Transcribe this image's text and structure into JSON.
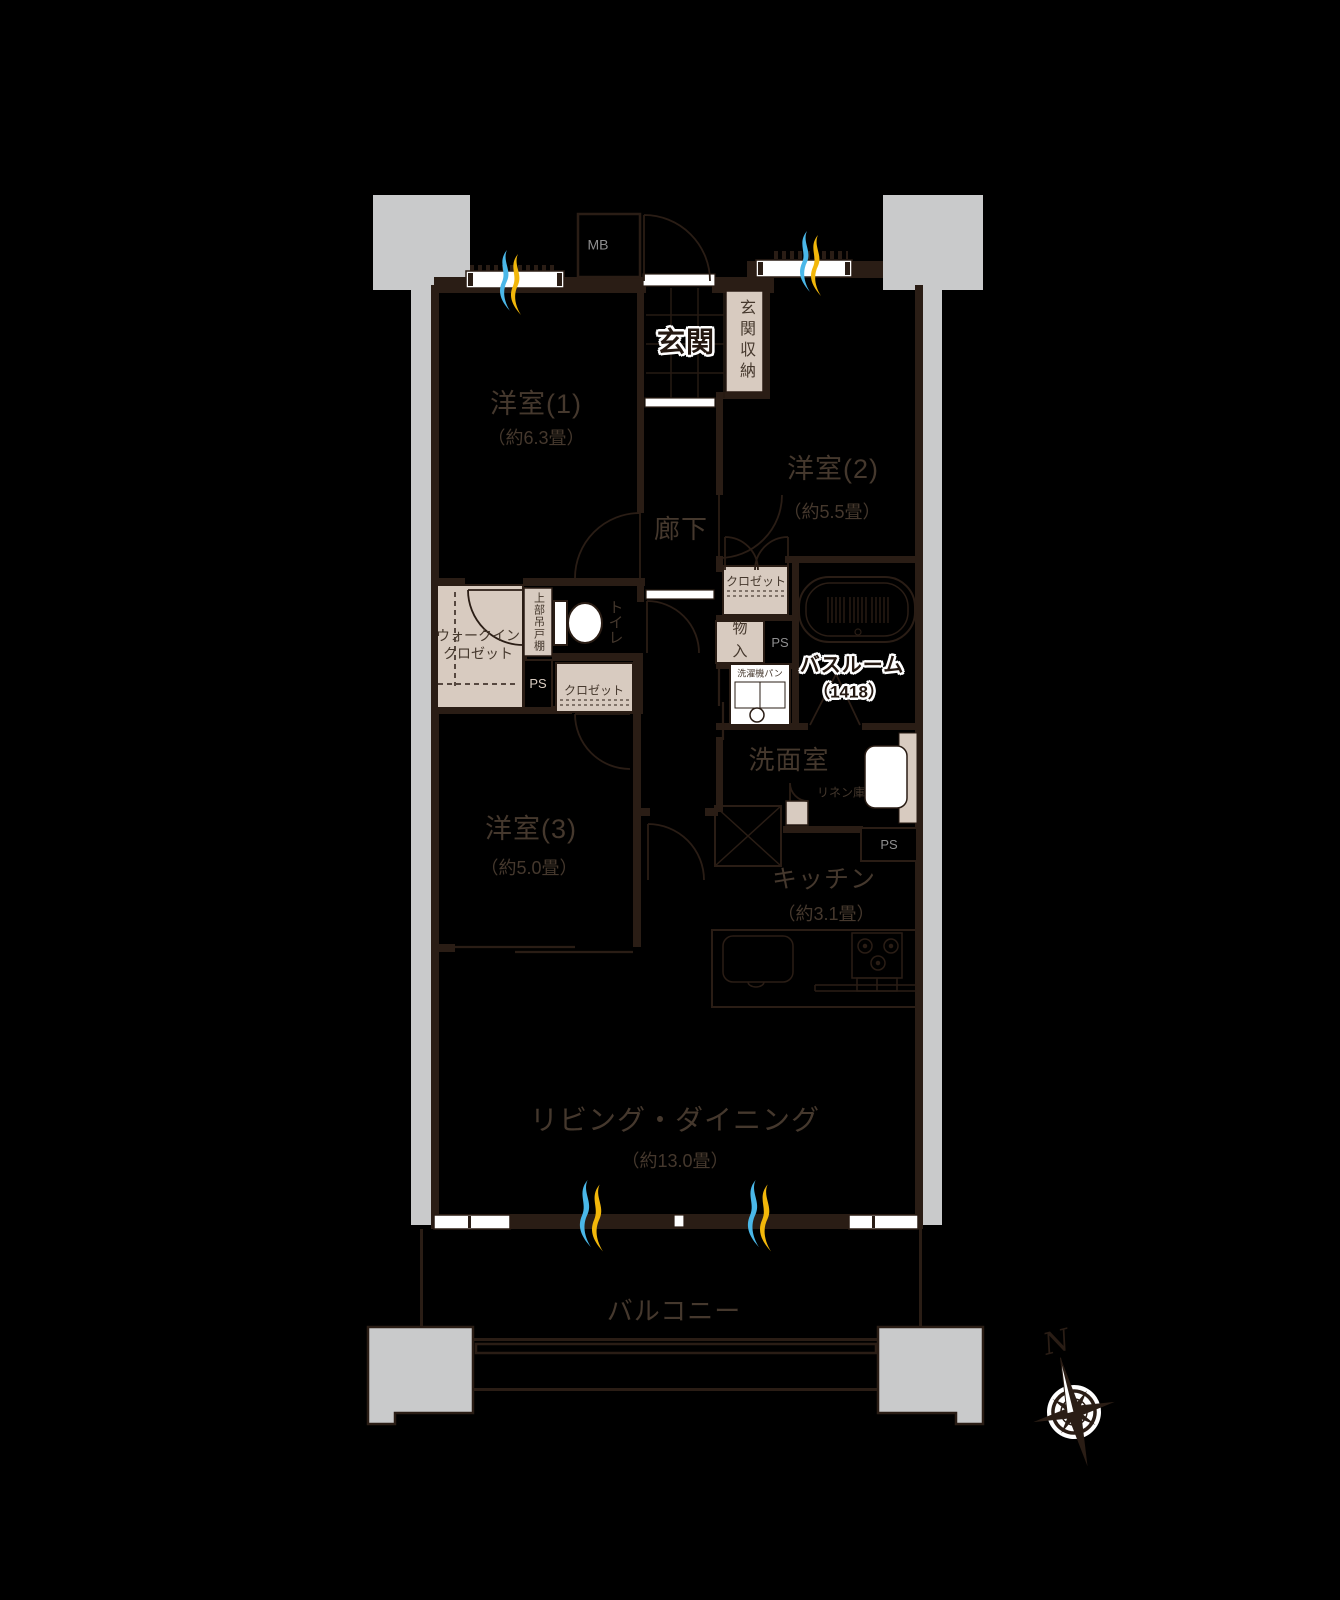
{
  "floorplan": {
    "rooms": {
      "western1": {
        "name": "洋室(1)",
        "size": "（約6.3畳）"
      },
      "western2": {
        "name": "洋室(2)",
        "size": "（約5.5畳）"
      },
      "western3": {
        "name": "洋室(3)",
        "size": "（約5.0畳）"
      },
      "living_dining": {
        "name": "リビング・ダイニング",
        "size": "（約13.0畳）"
      },
      "kitchen": {
        "name": "キッチン",
        "size": "（約3.1畳）"
      },
      "bathroom": {
        "name": "バスルーム",
        "size": "（1418）"
      },
      "entrance": "玄関",
      "corridor": "廊下",
      "washroom": "洗面室",
      "toilet": "トイレ",
      "balcony": "バルコニー"
    },
    "storage": {
      "walk_in_closet": "ウォークイン\nクロゼット",
      "entrance_storage": "玄関収納",
      "closet_west2": "クロゼット",
      "closet_west3": "クロゼット",
      "upper_cabinet": "上部吊戸棚",
      "storage_closet": "物入",
      "linen": "リネン庫"
    },
    "equipment": {
      "meter_box": "MB",
      "pipe_space": "PS",
      "washer_pan": "洗濯機パン"
    },
    "compass": {
      "north": "N"
    },
    "colors": {
      "wall": "#2a1d15",
      "fill_beige": "#d8cbc0",
      "pillar_gray": "#c9cacb",
      "airflow_blue": "#4ab7e8",
      "airflow_yellow": "#f2b70a"
    }
  }
}
